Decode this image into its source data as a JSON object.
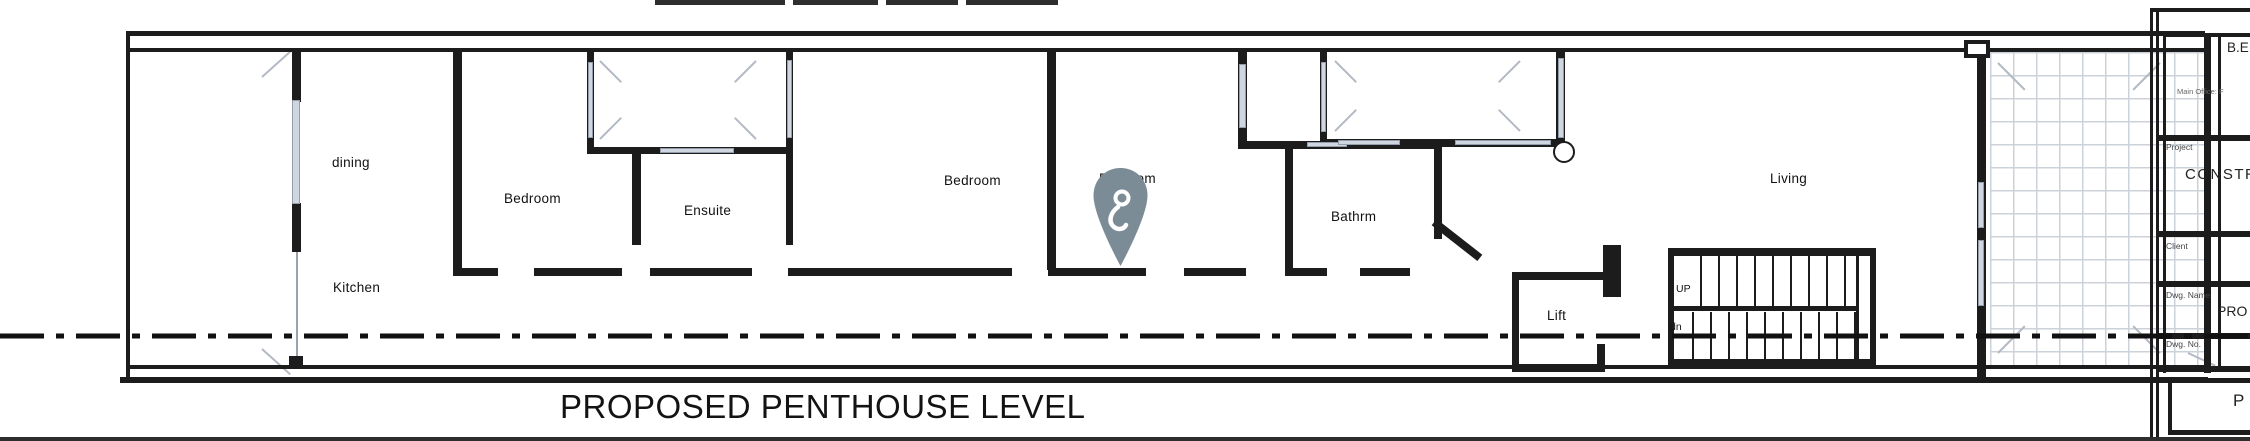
{
  "plan_title": "PROPOSED PENTHOUSE LEVEL",
  "rooms": [
    {
      "label": "dining"
    },
    {
      "label": "Kitchen"
    },
    {
      "label": "Bedroom"
    },
    {
      "label": "Ensuite"
    },
    {
      "label": "Bedroom"
    },
    {
      "label": "Bedroom"
    },
    {
      "label": "Bathrm"
    },
    {
      "label": "Lift"
    },
    {
      "label": "Living"
    }
  ],
  "stair": {
    "up_label": "UP",
    "down_label": "dn"
  },
  "marker": {
    "type": "location-pin",
    "color": "#7b8c97"
  },
  "title_block": {
    "logo_text": "B.E",
    "office_line": "Main Office: F",
    "fields": [
      {
        "label": "Project",
        "value": "CONSTR"
      },
      {
        "label": "Client",
        "value": ""
      },
      {
        "label": "Dwg. Name",
        "value": "PRO"
      },
      {
        "label": "Dwg. No.",
        "value": ""
      }
    ],
    "bottom_text": "P"
  },
  "colors": {
    "wall": "#1c1c1c",
    "window_fill": "#cfd6df",
    "tile_line": "#bcc3ce",
    "pin": "#7b8c97",
    "centerline": "#111111"
  }
}
